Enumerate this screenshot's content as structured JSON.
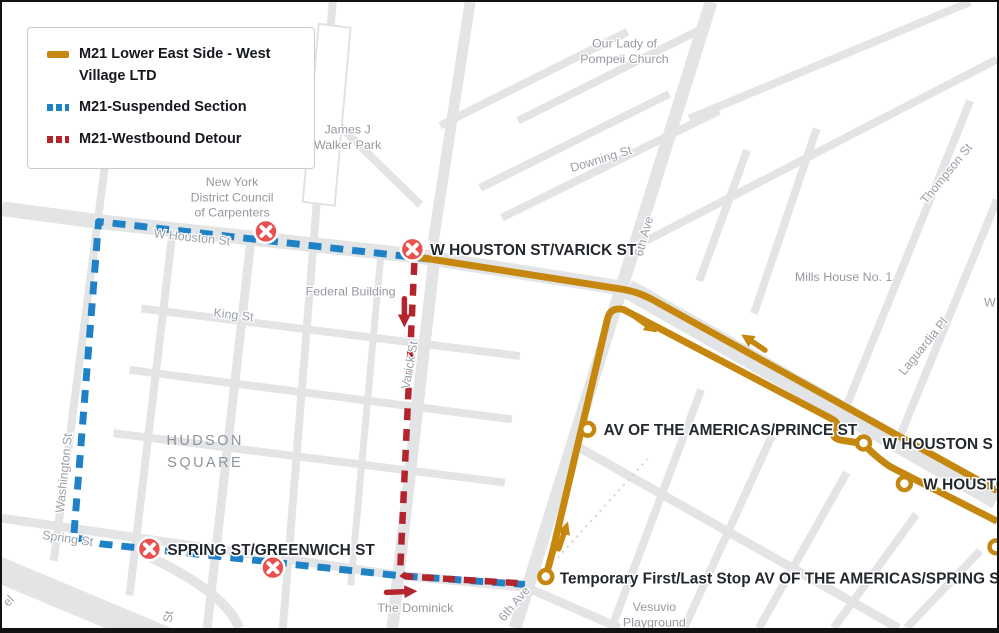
{
  "legend": {
    "items": [
      {
        "label": "M21 Lower East Side - West Village LTD",
        "style": "solid",
        "color": "#C5870E"
      },
      {
        "label": "M21-Suspended Section",
        "style": "dashed",
        "color": "#1F81C6"
      },
      {
        "label": "M21-Westbound Detour",
        "style": "dashed",
        "color": "#B3242C"
      }
    ]
  },
  "stops": {
    "closed_color": "#E8514F",
    "closed": [
      {
        "label": ""
      },
      {
        "label": "W HOUSTON ST/VARICK ST"
      },
      {
        "label": "SPRING ST/GREENWICH ST"
      },
      {
        "label": ""
      }
    ],
    "open": [
      {
        "label": "AV OF THE AMERICAS/PRINCE ST"
      },
      {
        "label": "W HOUSTON S"
      },
      {
        "label": "W HOUSTO"
      },
      {
        "label": "Temporary First/Last Stop AV OF THE AMERICAS/SPRING ST"
      },
      {
        "label": ""
      }
    ]
  },
  "street_labels": [
    "W Houston St",
    "King St",
    "Varick St",
    "Washington St",
    "Spring St",
    "6th Ave",
    "6th Ave",
    "Downing St",
    "Thompson St",
    "Laguardia Pl",
    "St",
    "el",
    "W"
  ],
  "poi_labels": [
    {
      "lines": [
        "Our Lady of",
        "Pompeii Church"
      ]
    },
    {
      "lines": [
        "James J",
        "Walker Park"
      ]
    },
    {
      "lines": [
        "New York",
        "District Council",
        "of Carpenters"
      ]
    },
    {
      "lines": [
        "Federal Building"
      ]
    },
    {
      "lines": [
        "HUDSON",
        "SQUARE"
      ]
    },
    {
      "lines": [
        "Mills House No. 1"
      ]
    },
    {
      "lines": [
        "The Dominick"
      ]
    },
    {
      "lines": [
        "Vesuvio",
        "Playground"
      ]
    }
  ]
}
